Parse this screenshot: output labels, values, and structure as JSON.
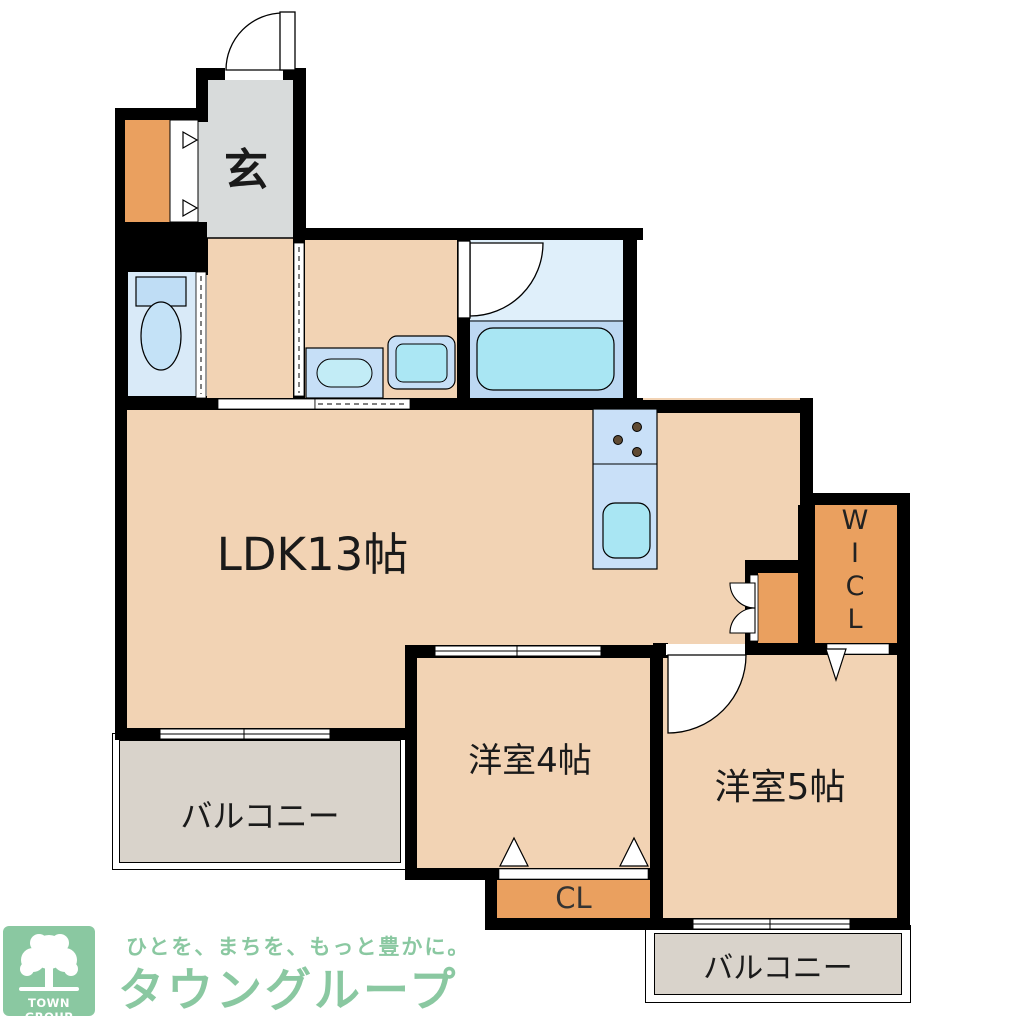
{
  "plan": {
    "entrance_label": "玄",
    "ldk_label": "LDK13帖",
    "room4_label": "洋室4帖",
    "room5_label": "洋室5帖",
    "balcony_left_label": "バルコニー",
    "balcony_bottom_label": "バルコニー",
    "closet_label": "CL",
    "wicl_letters": [
      "W",
      "I",
      "C",
      "L"
    ]
  },
  "branding": {
    "logo_text": "TOWN GROUP",
    "tagline": "ひとを、まちを、もっと豊かに。",
    "brand_name": "タウングループ",
    "brand_color": "#8AC8A1"
  },
  "colors": {
    "wall": "#000000",
    "room_beige": "#F2D3B4",
    "entry_gray": "#D8DBDB",
    "balcony_gray": "#D9D3CB",
    "closet_orange": "#EAA05F",
    "bath_light": "#DFEFFA",
    "tub_zone": "#BDD8F2",
    "toilet_room": "#D9EAF8",
    "fixture_blue": "#C6DFF7",
    "aqua": "#A9E6F3",
    "burner_brown": "#5F4A33"
  }
}
